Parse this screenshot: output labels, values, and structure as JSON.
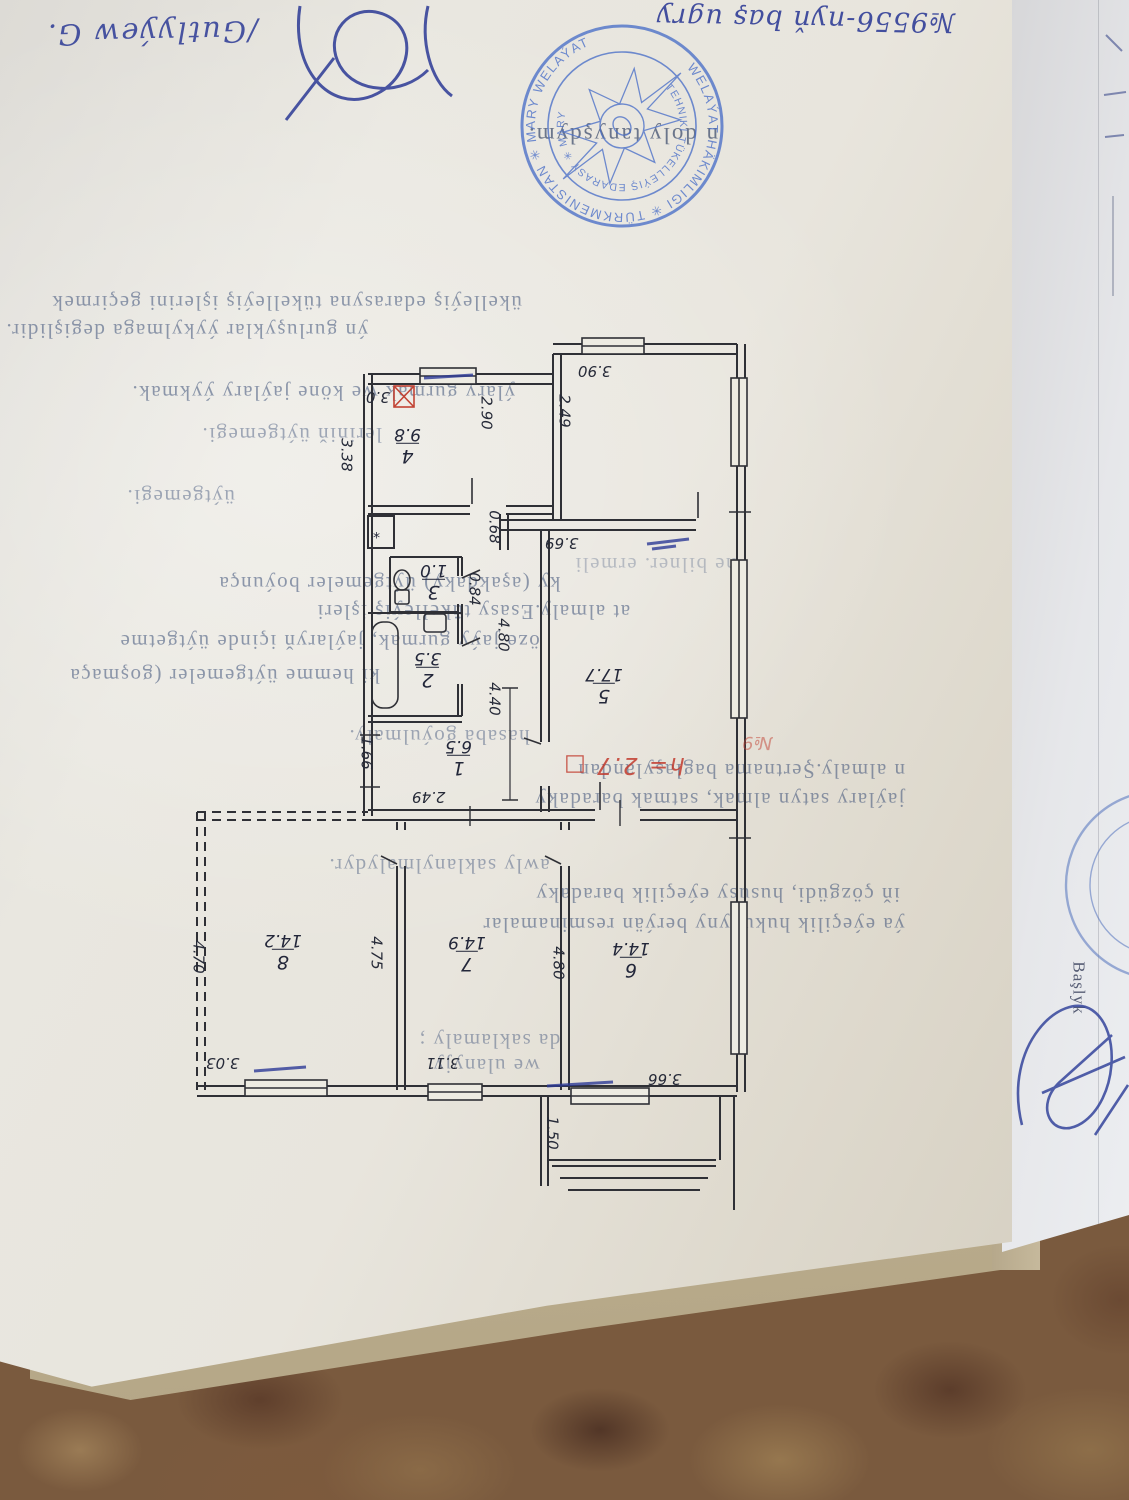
{
  "photo": {
    "scene": "paper documents lying on a carpet",
    "colors": {
      "carpet_base": "#7a5a3e",
      "carpet_dark": "#523627",
      "carpet_light": "#9a7b55",
      "paper_main": "#e7e4dc",
      "paper_second": "#e6e7ea",
      "backing": "#c4b697",
      "stamp_blue": "#4a6fc8",
      "ink_blue": "#2c3a96",
      "plan_ink": "#262a38",
      "red_ink": "#c23b2e",
      "printed_text": "#3c5078"
    }
  },
  "handwriting": {
    "top_number": "№9556-nyň baş ugry",
    "reviewer_name": "/Gutlyýew G."
  },
  "stamp": {
    "outer_ring": "WELAÝAT HÄKIMLIGI ✳ TÜRKMENISTAN ✳ MARY WELAÝAT",
    "inner_ring": "TEHNIKI TÜKELLEÝIŞ EDARASY ✳ MARY"
  },
  "printed": {
    "acknowledgement": "n doly tanyşdym.",
    "lines": [
      "ükelleýiş edarasyna tükelleýiş işlerini geçirmek",
      "ýn gurluşyklar ýykylmaga degişlidir.",
      "ýlary gurmak we köne jaýlary ýykmak.",
      "leriniň üýtgemegi.",
      "üýtgemegi.",
      "ne bilner. ermeli",
      "ky (aşakdaky) üýtgemeler boýunça",
      "at almaly.Esasy tükelleýiş işleri",
      "öze jaýy gurmak, jaýlaryň içinde üýtgetme",
      "ki hemme üýtgemeler (goşmaça",
      "hasaba goýulmaly.",
      "n almaly.Şertnama baglaşylandan",
      "jaýlary satyn almak, satmak baradaky",
      "awly saklanylmalydyr.",
      "iň çözgüdi, hususy eýeçilik baradaky",
      "ýa eýeçilik hukugyny berýän resminamalar",
      "da saklamaly ;",
      "we ulanyjy"
    ]
  },
  "plan": {
    "rooms": [
      {
        "number": "1",
        "area": "6.5"
      },
      {
        "number": "2",
        "area": "3.5"
      },
      {
        "number": "3",
        "area": "1.0"
      },
      {
        "number": "4",
        "area": "9.8"
      },
      {
        "number": "5",
        "area": "17.7"
      },
      {
        "number": "6",
        "area": "14.4"
      },
      {
        "number": "7",
        "area": "14.9"
      },
      {
        "number": "8",
        "area": "14.2"
      }
    ],
    "dims": {
      "d390": "3.90",
      "d290": "2.90",
      "d249a": "2.49",
      "d338": "3.38",
      "d30": "3.0",
      "d068": "0.68",
      "d369": "3.69",
      "d480a": "4.80",
      "d084": "0.84",
      "d440": "4.40",
      "d166": "1.66",
      "d249b": "2.49",
      "d470": "4.70",
      "d475": "4.75",
      "d480b": "4.80",
      "d303": "3.03",
      "d311": "3.11",
      "d366": "3.66",
      "d150": "1.50"
    },
    "red_height_note": "h= 2.7 □",
    "red_no": "№9",
    "flue_mark": "*"
  },
  "second_sheet": {
    "title": "Başlyk",
    "stamp_fragment": "A.W.TÜR"
  }
}
